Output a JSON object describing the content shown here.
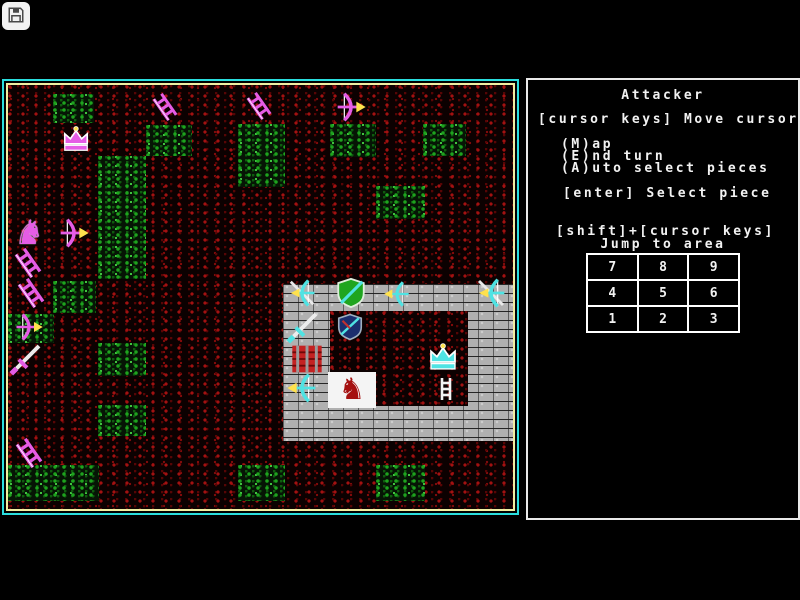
{
  "overlay": {
    "save_icon": "floppy-disk-save",
    "chevron": "›"
  },
  "panel": {
    "title": "Attacker",
    "move_line": "[cursor keys] Move cursor",
    "menu": [
      "(M)ap",
      "(E)nd turn",
      "(A)uto select pieces"
    ],
    "select_line": "[enter] Select piece",
    "jump_line1": "[shift]+[cursor keys]",
    "jump_line2": "Jump to area",
    "grid": [
      [
        "7",
        "8",
        "9"
      ],
      [
        "4",
        "5",
        "6"
      ],
      [
        "1",
        "2",
        "3"
      ]
    ]
  },
  "colors": {
    "attacker": "#e55ce5",
    "defender": "#4fe3e3",
    "map_border_outer": "#2adede",
    "map_border_inner": "#efefa2",
    "panel_border": "#eaeaea",
    "brick": "#b0b0b0",
    "gate_red": "#c42222",
    "arrow_yellow": "#ffe14d"
  },
  "map": {
    "patches": [
      {
        "x": 45,
        "y": 9,
        "w": 41,
        "h": 29
      },
      {
        "x": 138,
        "y": 40,
        "w": 46,
        "h": 31
      },
      {
        "x": 230,
        "y": 39,
        "w": 47,
        "h": 63
      },
      {
        "x": 322,
        "y": 39,
        "w": 46,
        "h": 33
      },
      {
        "x": 415,
        "y": 39,
        "w": 43,
        "h": 32
      },
      {
        "x": 90,
        "y": 71,
        "w": 48,
        "h": 123
      },
      {
        "x": 368,
        "y": 101,
        "w": 49,
        "h": 33
      },
      {
        "x": 45,
        "y": 196,
        "w": 43,
        "h": 32
      },
      {
        "x": 0,
        "y": 229,
        "w": 46,
        "h": 29
      },
      {
        "x": 90,
        "y": 258,
        "w": 48,
        "h": 33
      },
      {
        "x": 90,
        "y": 320,
        "w": 48,
        "h": 31
      },
      {
        "x": 0,
        "y": 380,
        "w": 91,
        "h": 36
      },
      {
        "x": 230,
        "y": 380,
        "w": 47,
        "h": 36
      },
      {
        "x": 368,
        "y": 380,
        "w": 49,
        "h": 36
      }
    ],
    "castle": {
      "x": 275,
      "y": 199,
      "w": 232,
      "h": 157,
      "courtyard": {
        "x": 322,
        "y": 226,
        "w": 138,
        "h": 95
      }
    },
    "pieces": [
      {
        "type": "crown",
        "side": "attacker",
        "x": 48,
        "y": 40,
        "w": 40,
        "h": 30
      },
      {
        "type": "ladder",
        "side": "attacker",
        "x": 140,
        "y": 8,
        "w": 34,
        "h": 28
      },
      {
        "type": "ladder",
        "side": "attacker",
        "x": 234,
        "y": 7,
        "w": 34,
        "h": 28
      },
      {
        "type": "bow",
        "side": "attacker",
        "x": 324,
        "y": 6,
        "w": 38,
        "h": 32
      },
      {
        "type": "horse",
        "side": "attacker",
        "x": 0,
        "y": 130,
        "w": 42,
        "h": 36
      },
      {
        "type": "bow",
        "side": "attacker",
        "x": 46,
        "y": 132,
        "w": 40,
        "h": 32
      },
      {
        "type": "ladder",
        "side": "attacker",
        "x": 2,
        "y": 163,
        "w": 36,
        "h": 30
      },
      {
        "type": "ladder",
        "side": "attacker",
        "x": 5,
        "y": 193,
        "w": 36,
        "h": 30
      },
      {
        "type": "bow",
        "side": "attacker",
        "x": 0,
        "y": 227,
        "w": 42,
        "h": 30
      },
      {
        "type": "sword",
        "side": "attacker",
        "x": 0,
        "y": 255,
        "w": 38,
        "h": 36
      },
      {
        "type": "ladder",
        "side": "attacker",
        "x": 4,
        "y": 353,
        "w": 34,
        "h": 30
      },
      {
        "type": "bowsword",
        "side": "defender",
        "x": 276,
        "y": 193,
        "w": 36,
        "h": 30,
        "flip": true
      },
      {
        "type": "shieldgreen",
        "side": "defender",
        "x": 323,
        "y": 191,
        "w": 40,
        "h": 34
      },
      {
        "type": "bow",
        "side": "defender",
        "x": 369,
        "y": 195,
        "w": 40,
        "h": 28,
        "flip": true
      },
      {
        "type": "bowsword",
        "side": "defender",
        "x": 463,
        "y": 192,
        "w": 40,
        "h": 32,
        "flip": true
      },
      {
        "type": "sword",
        "side": "defender",
        "x": 273,
        "y": 223,
        "w": 46,
        "h": 36
      },
      {
        "type": "shielddark",
        "side": "defender",
        "x": 324,
        "y": 227,
        "w": 36,
        "h": 30
      },
      {
        "type": "gate",
        "side": "defender",
        "x": 277,
        "y": 258,
        "w": 44,
        "h": 32
      },
      {
        "type": "bow",
        "side": "defender",
        "x": 271,
        "y": 287,
        "w": 46,
        "h": 32,
        "flip": true
      },
      {
        "type": "horsered",
        "side": "defender",
        "x": 320,
        "y": 287,
        "w": 48,
        "h": 36
      },
      {
        "type": "crown",
        "side": "defender",
        "x": 414,
        "y": 257,
        "w": 42,
        "h": 32
      },
      {
        "type": "ladderwhite",
        "side": "defender",
        "x": 426,
        "y": 288,
        "w": 24,
        "h": 32
      }
    ]
  }
}
